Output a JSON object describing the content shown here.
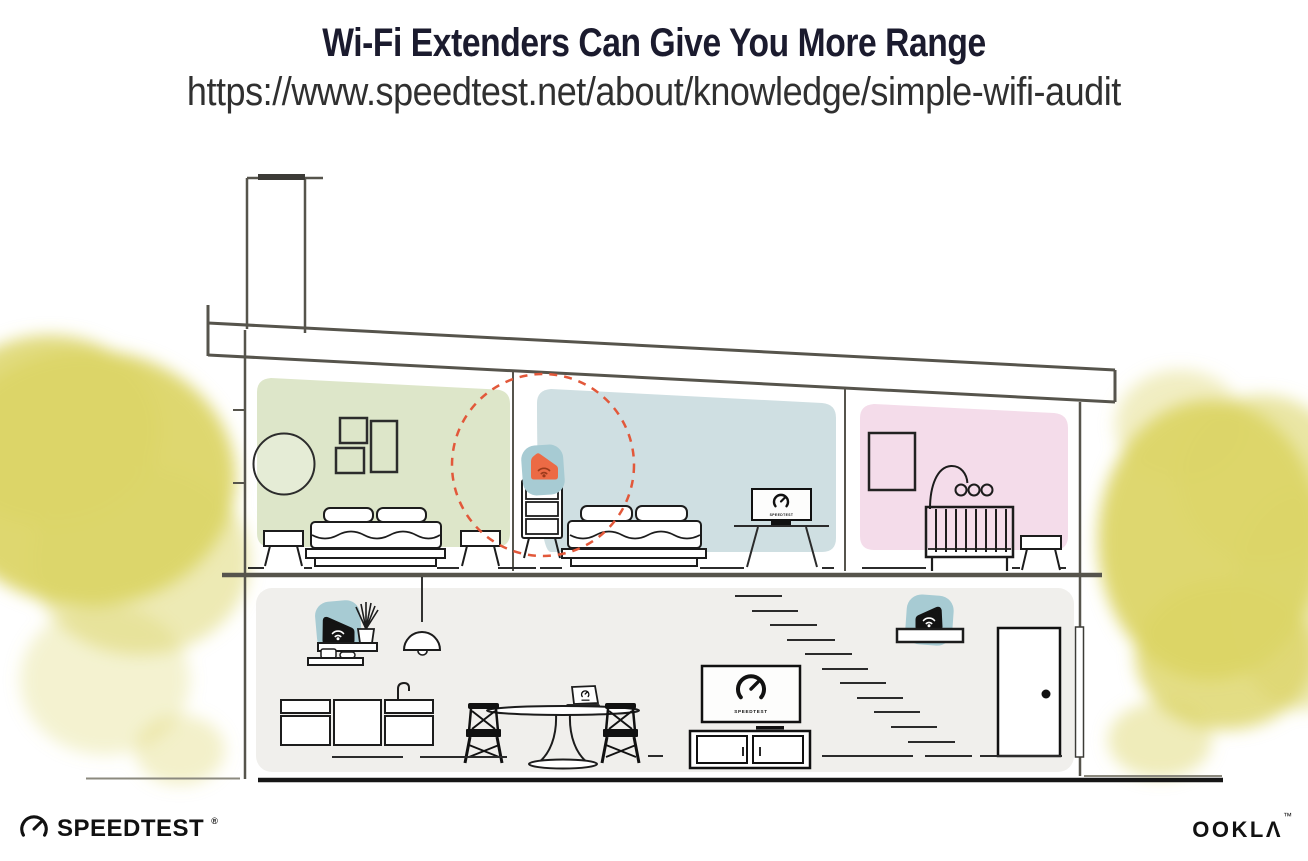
{
  "header": {
    "title": "Wi-Fi Extenders Can Give You More Range",
    "url": "https://www.speedtest.net/about/knowledge/simple-wifi-audit"
  },
  "branding": {
    "speedtest_wordmark": "SPEEDTEST",
    "speedtest_registered": "®",
    "ookla_wordmark": "OOKLΛ",
    "ookla_trademark": "™"
  },
  "illustration": {
    "screen_label": "SPEEDTEST",
    "colors": {
      "accent_orange": "#ec6a45",
      "wifi_icon_dark": "#9c3a1b",
      "range_ring": "#e2583a",
      "device_teal": "#a7cbd3",
      "device_black": "#131313",
      "room_green": "#dde6c9",
      "room_blue": "#cfdfe2",
      "room_pink": "#f4dcea",
      "lower_floor_gray": "#f0efec",
      "foliage_yellow": "#dcd567",
      "structure_gray": "#56544c"
    },
    "rooms": {
      "upper": [
        "green-bedroom",
        "hallway-with-extender",
        "blue-bedroom",
        "pink-nursery"
      ],
      "lower": [
        "kitchen-dining-living-room"
      ]
    },
    "devices": [
      "wifi-extender-orange-on-dresser",
      "wifi-router-black-on-shelf-left",
      "wifi-extender-black-on-shelf-right"
    ]
  }
}
